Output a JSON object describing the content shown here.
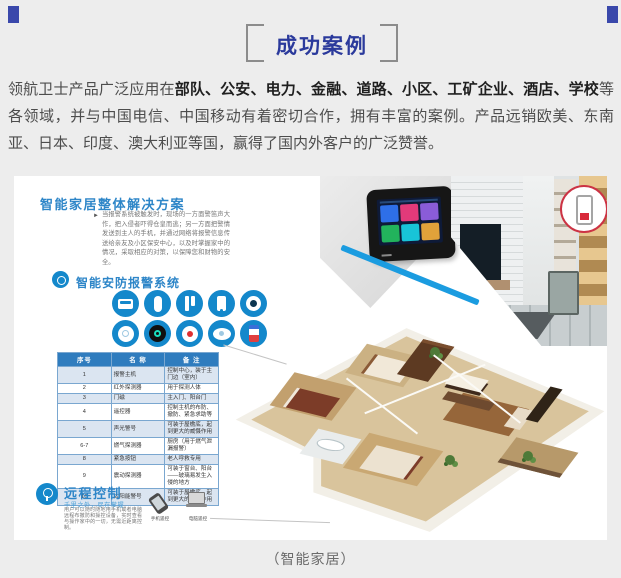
{
  "page": {
    "caption": "（智能家居）"
  },
  "header": {
    "title": "成功案例",
    "accent_color": "#2b3a9c"
  },
  "intro": {
    "prefix": "领航卫士产品广泛应用在",
    "bold": "部队、公安、电力、金融、道路、小区、工矿企业、酒店、学校",
    "suffix": "等各领域，并与中国电信、中国移动有着密切合作，拥有丰富的案例。产品远销欧美、东南亚、日本、印度、澳大利亚等国，赢得了国内外客户的广泛赞誉。"
  },
  "solution": {
    "title": "智能家居整体解决方案",
    "description": "当报警系统被触发时，现场的一方面警笛声大作，把入侵者吓得仓皇而逃；另一方面把警情发送到主人的手机，并通过网络将报警信息传送给亲友及小区保安中心，以及时掌握家中的情况，采取相应的对策，以保障您和财物的安全。",
    "security": {
      "title": "智能安防报警系统",
      "devices": [
        "报警主机",
        "红外探测器",
        "门磁",
        "遥控器",
        "摄像头",
        "烟雾探测器",
        "燃气探测器",
        "紧急按钮",
        "声光警号",
        "太阳能警号"
      ]
    },
    "table": {
      "headers": [
        "序号",
        "名 称",
        "备 注"
      ],
      "rows": [
        [
          "1",
          "报警主机",
          "控制中心，装于主门边（室内）"
        ],
        [
          "2",
          "红外探测器",
          "用于探测人体"
        ],
        [
          "3",
          "门磁",
          "主入门、阳台门"
        ],
        [
          "4",
          "遥控器",
          "控制主机的布防、撤防、紧急求助等"
        ],
        [
          "5",
          "声光警号",
          "可装于屋檐底，起到更大的威慑作用"
        ],
        [
          "6-7",
          "燃气探测器",
          "厨房（用于燃气泄漏报警）"
        ],
        [
          "8",
          "紧急按钮",
          "老人呼救专用"
        ],
        [
          "9",
          "震动探测器",
          "可装于窗台、阳台——玻璃易发生入侵的地方"
        ],
        [
          "10",
          "太阳能警号",
          "可装于屋檐底，起到更大的威慑作用"
        ]
      ]
    },
    "remote": {
      "title": "远程控制",
      "subtitle": "千里之外，尽在掌握",
      "description": "用户可以随时随地用手机或者电脑远程布撤防和操控设备，实时查看与操作家中的一切，无需近距离控制。",
      "icons": [
        {
          "label": "手机遥控"
        },
        {
          "label": "电脑遥控"
        }
      ]
    }
  },
  "colors": {
    "accent_blue": "#1488cb",
    "title_blue": "#2b3a9c",
    "table_header": "#2f7cbe",
    "stripe_blue": "#1b9ce0",
    "callout_red": "#cc3344"
  }
}
